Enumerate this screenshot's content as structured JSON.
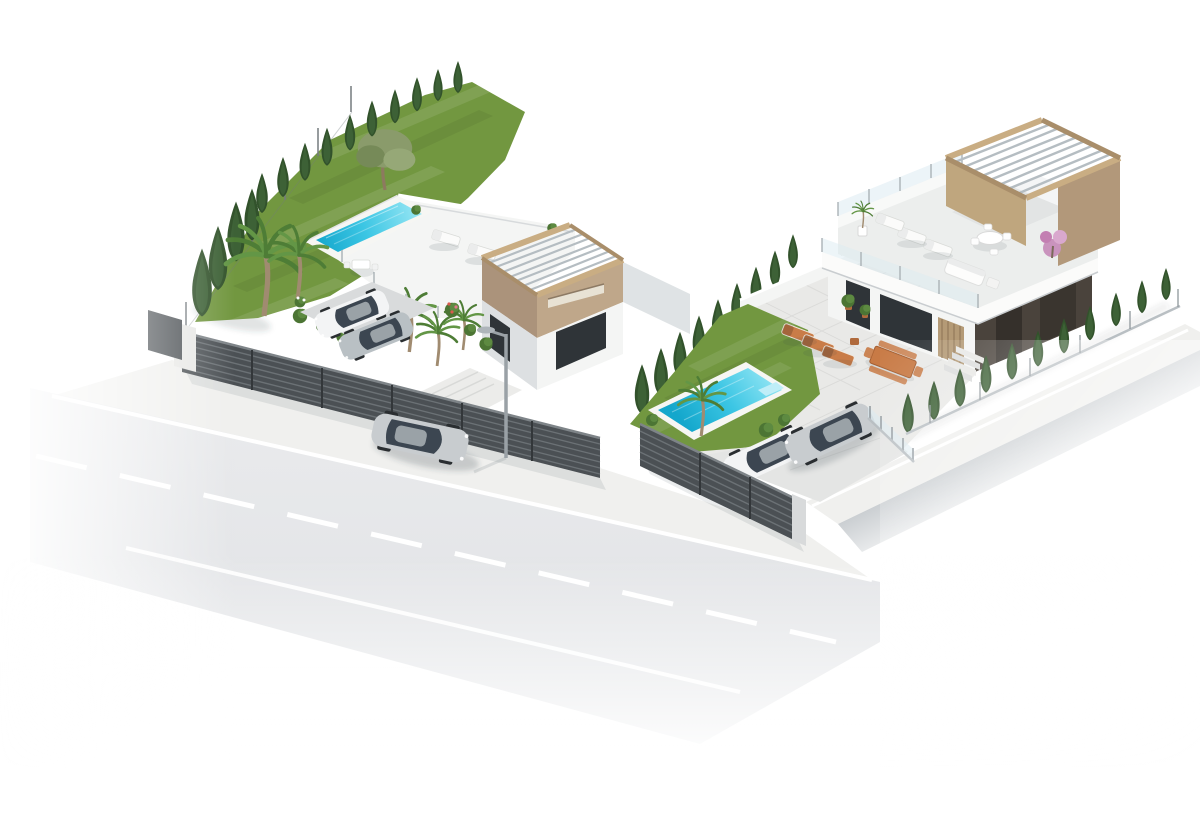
{
  "caption": "Aerial 3D architectural render of two modern white villas with rooftop pergola terraces, gardens, swimming pools and parked cars on a corner street",
  "counts": {
    "villas": 2,
    "swimming_pools": 2,
    "cars": 5,
    "street_lamps": 1,
    "roads": 1
  },
  "colors": {
    "background": "#ffffff",
    "road_line": "#ffffff",
    "sidewalk": "#f0f0ee",
    "fence_dark": "#4b5054",
    "fence_slat": "#6b7175",
    "wall_white": "#f4f5f4",
    "wall_shadow": "#dde0e2",
    "wall_beige": "#bfa78a",
    "wall_beige_dark": "#ab937b",
    "wood": "#c9ad83",
    "wood_dark": "#a98e6a",
    "glass": "#dcebf2",
    "window_dark": "#2f3438",
    "facade_dark": "#4a433c",
    "grass": "#729740",
    "hedge": "#32522b",
    "hedge_light": "#40653a",
    "olive": "#8a9b6b",
    "palm": "#4e7d36",
    "palm_light": "#639646",
    "pool_coping": "#f6f6f3",
    "terracotta": "#c97c48",
    "car_silver": "#c8cccf",
    "car_silver2": "#b9c0c4",
    "car_white": "#f3f4f5",
    "car_glass": "#3c4651",
    "wall_gray": "#bfc4c8",
    "paving": "#e9e9e7",
    "lamp_gray": "#9aa1a6"
  }
}
